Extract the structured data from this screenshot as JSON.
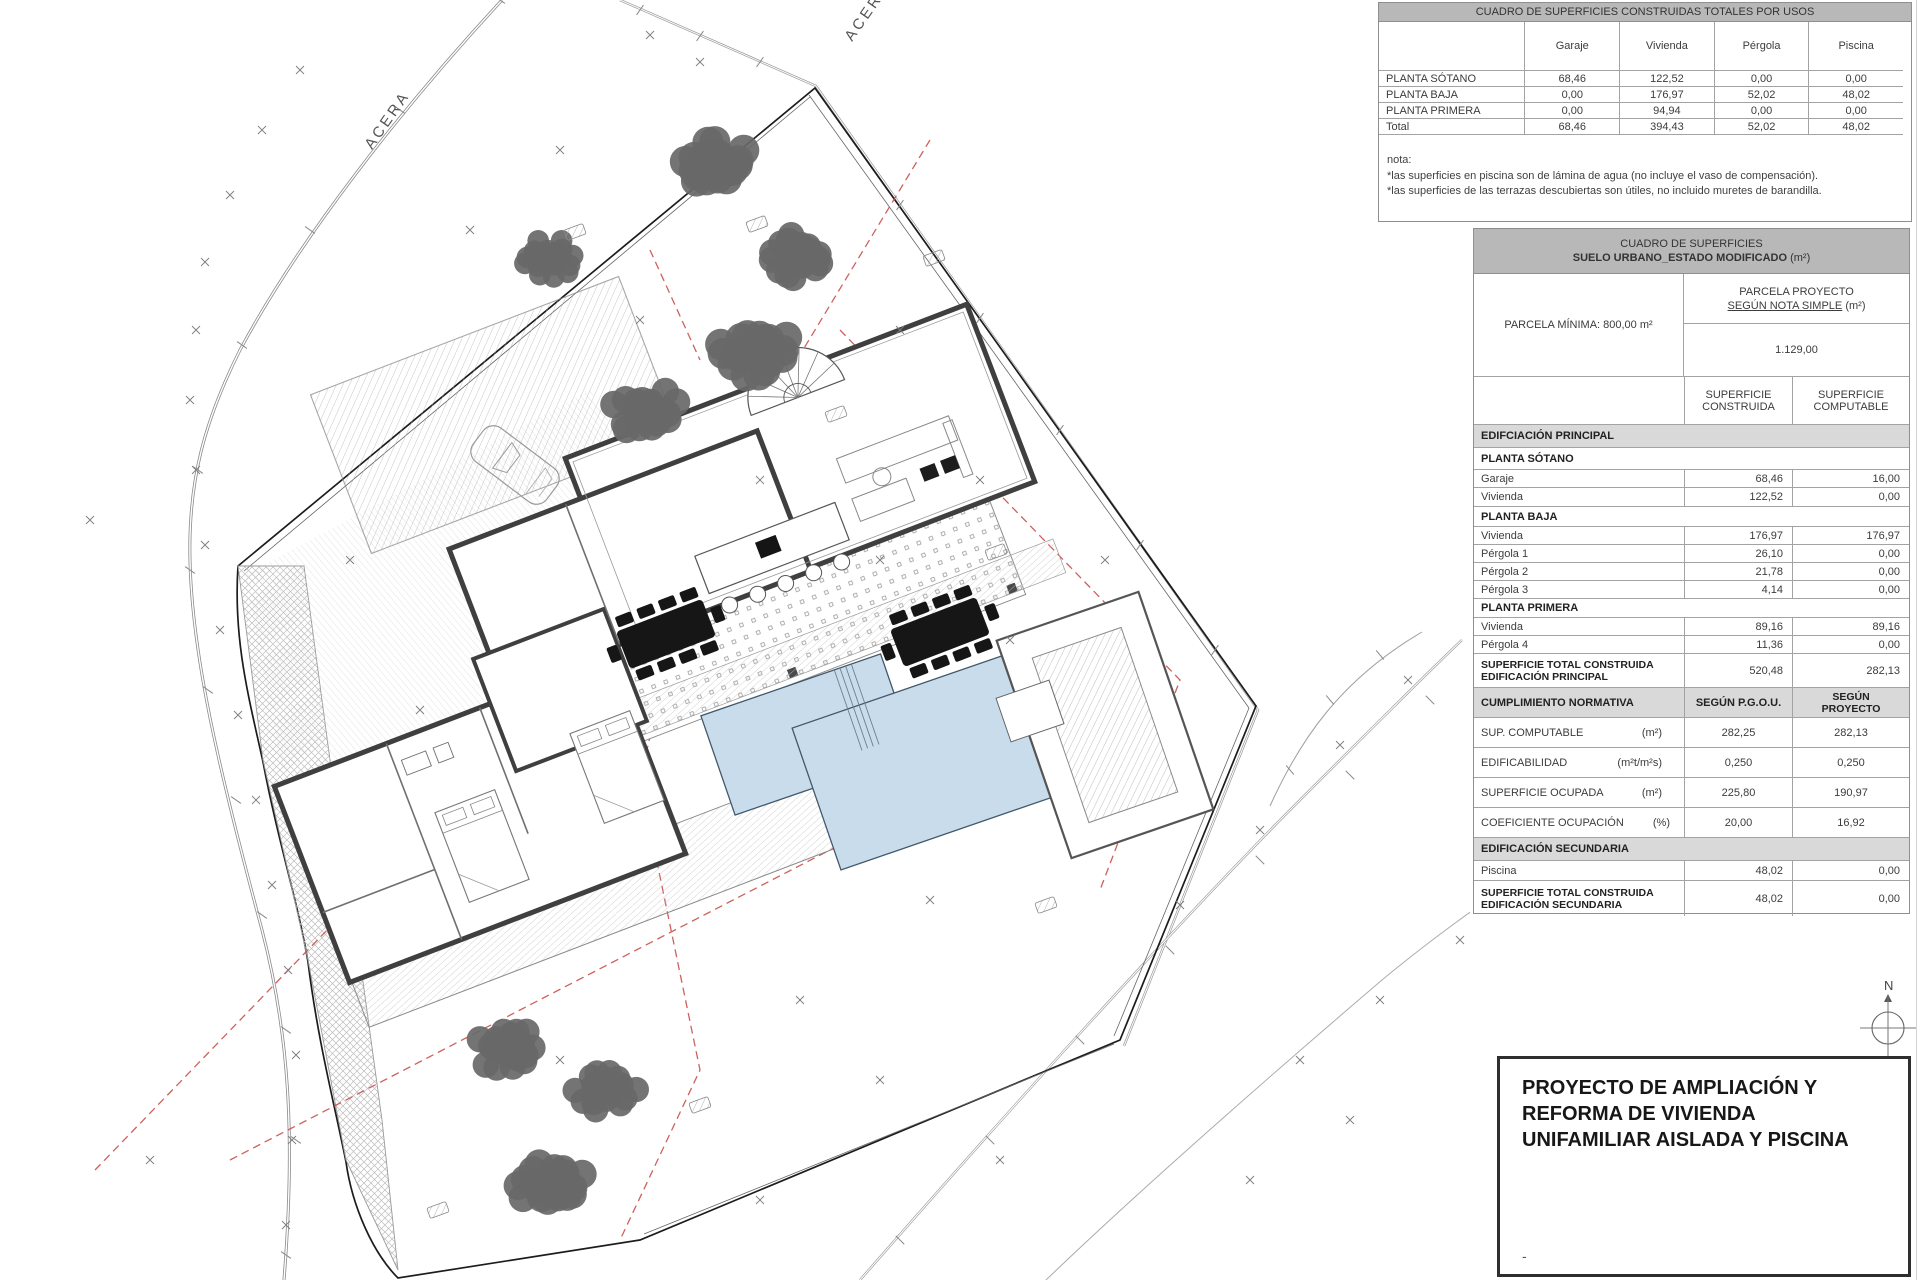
{
  "plan": {
    "acera1": "ACERA",
    "acera2": "ACERA",
    "north": "N"
  },
  "colors": {
    "pool": "#c9dcec",
    "pool_edge": "#41586b",
    "red_dash": "#c9504a",
    "tree": "#686868",
    "header_gray": "#b8b8b8",
    "band_gray": "#d9d9d9"
  },
  "usos": {
    "title": "CUADRO DE SUPERFICIES CONSTRUIDAS TOTALES POR USOS",
    "col_headers": {
      "c1": "Garaje",
      "c2": "Vivienda",
      "c3": "Pérgola",
      "c4": "Piscina"
    },
    "rows": [
      {
        "label": "PLANTA SÓTANO",
        "v1": "68,46",
        "v2": "122,52",
        "v3": "0,00",
        "v4": "0,00"
      },
      {
        "label": "PLANTA BAJA",
        "v1": "0,00",
        "v2": "176,97",
        "v3": "52,02",
        "v4": "48,02"
      },
      {
        "label": "PLANTA PRIMERA",
        "v1": "0,00",
        "v2": "94,94",
        "v3": "0,00",
        "v4": "0,00"
      },
      {
        "label": "Total",
        "v1": "68,46",
        "v2": "394,43",
        "v3": "52,02",
        "v4": "48,02"
      }
    ],
    "notes": {
      "l1": "nota:",
      "l2": "*las superficies en piscina son de lámina de agua (no incluye el vaso de compensación).",
      "l3": "*las superficies de las terrazas descubiertas son útiles, no incluido muretes de barandilla."
    }
  },
  "sup": {
    "title1": "CUADRO DE SUPERFICIES",
    "title2": "SUELO URBANO_ESTADO MODIFICADO",
    "title2_unit": "(m²)",
    "parcela_min": "PARCELA MÍNIMA: 800,00 m²",
    "pp1": "PARCELA PROYECTO",
    "pp2": "SEGÚN NOTA SIMPLE",
    "pp2_unit": "(m²)",
    "parcela_val": "1.129,00",
    "colA1": "SUPERFICIE",
    "colA2": "CONSTRUIDA",
    "colB1": "SUPERFICIE",
    "colB2": "COMPUTABLE",
    "band1": "EDIFCIACIÓN PRINCIPAL",
    "sections": {
      "s1": "PLANTA SÓTANO",
      "s2": "PLANTA BAJA",
      "s3": "PLANTA PRIMERA"
    },
    "rows": [
      {
        "label": "Garaje",
        "v1": "68,46",
        "v2": "16,00"
      },
      {
        "label": "Vivienda",
        "v1": "122,52",
        "v2": "0,00"
      },
      {
        "label": "Vivienda",
        "v1": "176,97",
        "v2": "176,97"
      },
      {
        "label": "Pérgola 1",
        "v1": "26,10",
        "v2": "0,00"
      },
      {
        "label": "Pérgola 2",
        "v1": "21,78",
        "v2": "0,00"
      },
      {
        "label": "Pérgola 3",
        "v1": "4,14",
        "v2": "0,00"
      },
      {
        "label": "Vivienda",
        "v1": "89,16",
        "v2": "89,16"
      },
      {
        "label": "Pérgola 4",
        "v1": "11,36",
        "v2": "0,00"
      }
    ],
    "tot1a": "SUPERFICIE TOTAL CONSTRUIDA",
    "tot1b": "EDIFICACIÓN PRINCIPAL",
    "tot1v1": "520,48",
    "tot1v2": "282,13",
    "cn": "CUMPLIMIENTO NORMATIVA",
    "cnA": "SEGÚN P.G.O.U.",
    "cnB1": "SEGÚN",
    "cnB2": "PROYECTO",
    "norm_rows": [
      {
        "label": "SUP. COMPUTABLE",
        "unit": "(m²)",
        "v1": "282,25",
        "v2": "282,13"
      },
      {
        "label": "EDIFICABILIDAD",
        "unit": "(m²t/m²s)",
        "v1": "0,250",
        "v2": "0,250"
      },
      {
        "label": "SUPERFICIE OCUPADA",
        "unit": "(m²)",
        "v1": "225,80",
        "v2": "190,97"
      },
      {
        "label": "COEFICIENTE OCUPACIÓN",
        "unit": "(%)",
        "v1": "20,00",
        "v2": "16,92"
      }
    ],
    "band2": "EDIFICACIÓN SECUNDARIA",
    "pisc": {
      "label": "Piscina",
      "v1": "48,02",
      "v2": "0,00"
    },
    "tot2a": "SUPERFICIE TOTAL CONSTRUIDA",
    "tot2b": "EDIFICACIÓN SECUNDARIA",
    "tot2v1": "48,02",
    "tot2v2": "0,00"
  },
  "title_block": {
    "line1": "PROYECTO DE AMPLIACIÓN Y",
    "line2": "REFORMA DE VIVIENDA",
    "line3": "UNIFAMILIAR AISLADA Y PISCINA",
    "mark": "-"
  }
}
